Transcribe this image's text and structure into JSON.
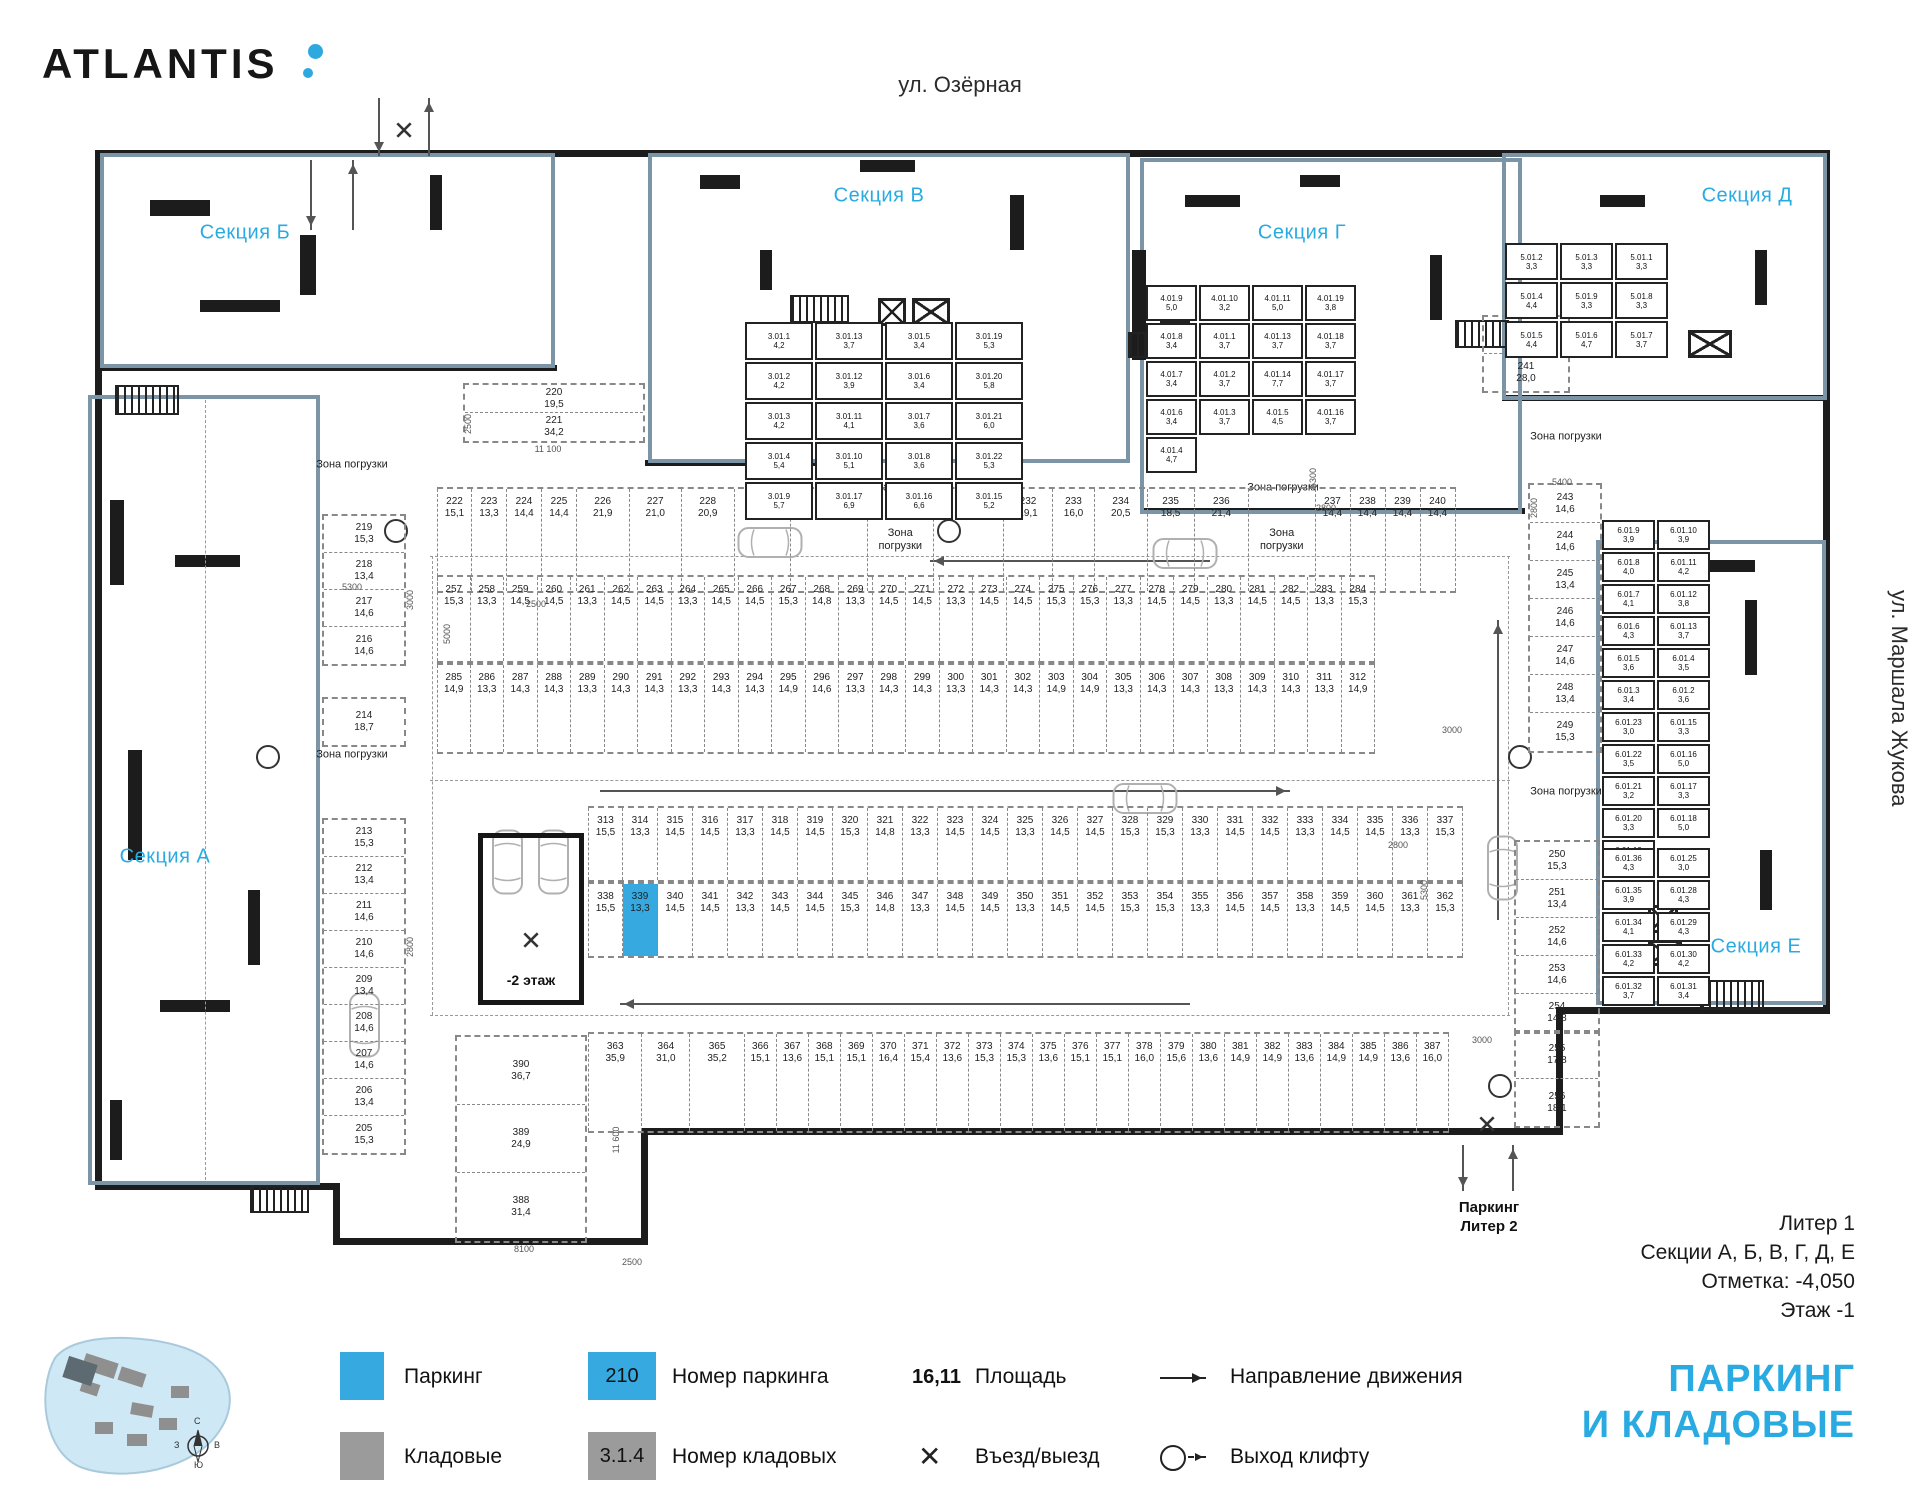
{
  "header": {
    "brand": "ATLANTIS",
    "street_top": "ул. Озёрная",
    "street_right": "ул. Маршала Жукова"
  },
  "sections": {
    "a": "Секция А",
    "b": "Секция Б",
    "v": "Секция В",
    "g": "Секция Г",
    "d": "Секция Д",
    "e": "Секция Е"
  },
  "labels": {
    "zone": "Зона погрузки",
    "ramp": "-2 этаж",
    "exit_l1": "Паркинг",
    "exit_l2": "Литер 2"
  },
  "highlight": {
    "parking_number": "339"
  },
  "plan": {
    "row_top": [
      {
        "n": "222",
        "a": "15,1"
      },
      {
        "n": "223",
        "a": "13,3"
      },
      {
        "n": "224",
        "a": "14,4"
      },
      {
        "n": "225",
        "a": "14,4"
      },
      {
        "n": "226",
        "a": "21,9",
        "w": 1.5
      },
      {
        "n": "227",
        "a": "21,0",
        "w": 1.5
      },
      {
        "n": "228",
        "a": "20,9",
        "w": 1.5
      },
      {
        "n": "229",
        "a": "22,4",
        "w": 1.6
      },
      {
        "n": "230",
        "a": "32,3",
        "w": 2.2
      },
      {
        "z": true,
        "w": 1.9
      },
      {
        "n": "231",
        "a": "28,2",
        "w": 2.0
      },
      {
        "n": "232",
        "a": "19,1",
        "w": 1.4
      },
      {
        "n": "233",
        "a": "16,0",
        "w": 1.2
      },
      {
        "n": "234",
        "a": "20,5",
        "w": 1.5
      },
      {
        "n": "235",
        "a": "18,5",
        "w": 1.35
      },
      {
        "n": "236",
        "a": "21,4",
        "w": 1.55
      },
      {
        "z": true,
        "w": 1.9
      },
      {
        "n": "237",
        "a": "14,4"
      },
      {
        "n": "238",
        "a": "14,4"
      },
      {
        "n": "239",
        "a": "14,4"
      },
      {
        "n": "240",
        "a": "14,4"
      }
    ],
    "row_a": [
      {
        "n": "257",
        "a": "15,3"
      },
      {
        "n": "258",
        "a": "13,3"
      },
      {
        "n": "259",
        "a": "14,5"
      },
      {
        "n": "260",
        "a": "14,5"
      },
      {
        "n": "261",
        "a": "13,3"
      },
      {
        "n": "262",
        "a": "14,5"
      },
      {
        "n": "263",
        "a": "14,5"
      },
      {
        "n": "264",
        "a": "13,3"
      },
      {
        "n": "265",
        "a": "14,5"
      },
      {
        "n": "266",
        "a": "14,5"
      },
      {
        "n": "267",
        "a": "15,3"
      },
      {
        "n": "268",
        "a": "14,8"
      },
      {
        "n": "269",
        "a": "13,3"
      },
      {
        "n": "270",
        "a": "14,5"
      },
      {
        "n": "271",
        "a": "14,5"
      },
      {
        "n": "272",
        "a": "13,3"
      },
      {
        "n": "273",
        "a": "14,5"
      },
      {
        "n": "274",
        "a": "14,5"
      },
      {
        "n": "275",
        "a": "15,3"
      },
      {
        "n": "276",
        "a": "15,3"
      },
      {
        "n": "277",
        "a": "13,3"
      },
      {
        "n": "278",
        "a": "14,5"
      },
      {
        "n": "279",
        "a": "14,5"
      },
      {
        "n": "280",
        "a": "13,3"
      },
      {
        "n": "281",
        "a": "14,5"
      },
      {
        "n": "282",
        "a": "14,5"
      },
      {
        "n": "283",
        "a": "13,3"
      },
      {
        "n": "284",
        "a": "15,3"
      }
    ],
    "row_b": [
      {
        "n": "285",
        "a": "14,9"
      },
      {
        "n": "286",
        "a": "13,3"
      },
      {
        "n": "287",
        "a": "14,3"
      },
      {
        "n": "288",
        "a": "14,3"
      },
      {
        "n": "289",
        "a": "13,3"
      },
      {
        "n": "290",
        "a": "14,3"
      },
      {
        "n": "291",
        "a": "14,3"
      },
      {
        "n": "292",
        "a": "13,3"
      },
      {
        "n": "293",
        "a": "14,3"
      },
      {
        "n": "294",
        "a": "14,3"
      },
      {
        "n": "295",
        "a": "14,9"
      },
      {
        "n": "296",
        "a": "14,6"
      },
      {
        "n": "297",
        "a": "13,3"
      },
      {
        "n": "298",
        "a": "14,3"
      },
      {
        "n": "299",
        "a": "14,3"
      },
      {
        "n": "300",
        "a": "13,3"
      },
      {
        "n": "301",
        "a": "14,3"
      },
      {
        "n": "302",
        "a": "14,3"
      },
      {
        "n": "303",
        "a": "14,9"
      },
      {
        "n": "304",
        "a": "14,9"
      },
      {
        "n": "305",
        "a": "13,3"
      },
      {
        "n": "306",
        "a": "14,3"
      },
      {
        "n": "307",
        "a": "14,3"
      },
      {
        "n": "308",
        "a": "13,3"
      },
      {
        "n": "309",
        "a": "14,3"
      },
      {
        "n": "310",
        "a": "14,3"
      },
      {
        "n": "311",
        "a": "13,3"
      },
      {
        "n": "312",
        "a": "14,9"
      }
    ],
    "row_c": [
      {
        "n": "313",
        "a": "15,5"
      },
      {
        "n": "314",
        "a": "13,3"
      },
      {
        "n": "315",
        "a": "14,5"
      },
      {
        "n": "316",
        "a": "14,5"
      },
      {
        "n": "317",
        "a": "13,3"
      },
      {
        "n": "318",
        "a": "14,5"
      },
      {
        "n": "319",
        "a": "14,5"
      },
      {
        "n": "320",
        "a": "15,3"
      },
      {
        "n": "321",
        "a": "14,8"
      },
      {
        "n": "322",
        "a": "13,3"
      },
      {
        "n": "323",
        "a": "14,5"
      },
      {
        "n": "324",
        "a": "14,5"
      },
      {
        "n": "325",
        "a": "13,3"
      },
      {
        "n": "326",
        "a": "14,5"
      },
      {
        "n": "327",
        "a": "14,5"
      },
      {
        "n": "328",
        "a": "15,3"
      },
      {
        "n": "329",
        "a": "15,3"
      },
      {
        "n": "330",
        "a": "13,3"
      },
      {
        "n": "331",
        "a": "14,5"
      },
      {
        "n": "332",
        "a": "14,5"
      },
      {
        "n": "333",
        "a": "13,3"
      },
      {
        "n": "334",
        "a": "14,5"
      },
      {
        "n": "335",
        "a": "14,5"
      },
      {
        "n": "336",
        "a": "13,3"
      },
      {
        "n": "337",
        "a": "15,3"
      }
    ],
    "row_d": [
      {
        "n": "338",
        "a": "15,5"
      },
      {
        "n": "339",
        "a": "13,3"
      },
      {
        "n": "340",
        "a": "14,5"
      },
      {
        "n": "341",
        "a": "14,5"
      },
      {
        "n": "342",
        "a": "13,3"
      },
      {
        "n": "343",
        "a": "14,5"
      },
      {
        "n": "344",
        "a": "14,5"
      },
      {
        "n": "345",
        "a": "15,3"
      },
      {
        "n": "346",
        "a": "14,8"
      },
      {
        "n": "347",
        "a": "13,3"
      },
      {
        "n": "348",
        "a": "14,5"
      },
      {
        "n": "349",
        "a": "14,5"
      },
      {
        "n": "350",
        "a": "13,3"
      },
      {
        "n": "351",
        "a": "14,5"
      },
      {
        "n": "352",
        "a": "14,5"
      },
      {
        "n": "353",
        "a": "15,3"
      },
      {
        "n": "354",
        "a": "15,3"
      },
      {
        "n": "355",
        "a": "13,3"
      },
      {
        "n": "356",
        "a": "14,5"
      },
      {
        "n": "357",
        "a": "14,5"
      },
      {
        "n": "358",
        "a": "13,3"
      },
      {
        "n": "359",
        "a": "14,5"
      },
      {
        "n": "360",
        "a": "14,5"
      },
      {
        "n": "361",
        "a": "13,3"
      },
      {
        "n": "362",
        "a": "15,3"
      }
    ],
    "row_e": [
      {
        "n": "363",
        "a": "35,9",
        "w": 1.7
      },
      {
        "n": "364",
        "a": "31,0",
        "w": 1.5
      },
      {
        "n": "365",
        "a": "35,2",
        "w": 1.7
      },
      {
        "n": "366",
        "a": "15,1"
      },
      {
        "n": "367",
        "a": "13,6"
      },
      {
        "n": "368",
        "a": "15,1"
      },
      {
        "n": "369",
        "a": "15,1"
      },
      {
        "n": "370",
        "a": "16,4"
      },
      {
        "n": "371",
        "a": "15,4"
      },
      {
        "n": "372",
        "a": "13,6"
      },
      {
        "n": "373",
        "a": "15,3"
      },
      {
        "n": "374",
        "a": "15,3"
      },
      {
        "n": "375",
        "a": "13,6"
      },
      {
        "n": "376",
        "a": "15,1"
      },
      {
        "n": "377",
        "a": "15,1"
      },
      {
        "n": "378",
        "a": "16,0"
      },
      {
        "n": "379",
        "a": "15,6"
      },
      {
        "n": "380",
        "a": "13,6"
      },
      {
        "n": "381",
        "a": "14,9"
      },
      {
        "n": "382",
        "a": "14,9"
      },
      {
        "n": "383",
        "a": "13,6"
      },
      {
        "n": "384",
        "a": "14,9"
      },
      {
        "n": "385",
        "a": "14,9"
      },
      {
        "n": "386",
        "a": "13,6"
      },
      {
        "n": "387",
        "a": "16,0"
      }
    ],
    "pair_220": [
      {
        "n": "220",
        "a": "19,5"
      },
      {
        "n": "221",
        "a": "34,2"
      }
    ],
    "left_col_top": [
      {
        "n": "219",
        "a": "15,3"
      },
      {
        "n": "218",
        "a": "13,4"
      },
      {
        "n": "217",
        "a": "14,6"
      },
      {
        "n": "216",
        "a": "14,6"
      }
    ],
    "cell_214": [
      {
        "n": "214",
        "a": "18,7"
      }
    ],
    "left_col_bottom": [
      {
        "n": "213",
        "a": "15,3"
      },
      {
        "n": "212",
        "a": "13,4"
      },
      {
        "n": "211",
        "a": "14,6"
      },
      {
        "n": "210",
        "a": "14,6"
      },
      {
        "n": "209",
        "a": "13,4"
      },
      {
        "n": "208",
        "a": "14,6"
      },
      {
        "n": "207",
        "a": "14,6"
      },
      {
        "n": "206",
        "a": "13,4"
      },
      {
        "n": "205",
        "a": "15,3"
      }
    ],
    "pair_242": [
      {
        "n": "242",
        "a": "20,3"
      },
      {
        "n": "241",
        "a": "28,0"
      }
    ],
    "right_col_top": [
      {
        "n": "243",
        "a": "14,6"
      },
      {
        "n": "244",
        "a": "14,6"
      },
      {
        "n": "245",
        "a": "13,4"
      },
      {
        "n": "246",
        "a": "14,6"
      },
      {
        "n": "247",
        "a": "14,6"
      },
      {
        "n": "248",
        "a": "13,4"
      },
      {
        "n": "249",
        "a": "15,3"
      }
    ],
    "right_col_bottom": [
      {
        "n": "250",
        "a": "15,3"
      },
      {
        "n": "251",
        "a": "13,4"
      },
      {
        "n": "252",
        "a": "14,6"
      },
      {
        "n": "253",
        "a": "14,6"
      },
      {
        "n": "254",
        "a": "14,8"
      }
    ],
    "cells_255_256": [
      {
        "n": "255",
        "a": "17,8"
      },
      {
        "n": "256",
        "a": "18,1"
      }
    ],
    "block_388_390": [
      {
        "n": "390",
        "a": "36,7"
      },
      {
        "n": "389",
        "a": "24,9"
      },
      {
        "n": "388",
        "a": "31,4"
      }
    ],
    "storage_v": [
      {
        "n": "3.01.1",
        "a": "4,2"
      },
      {
        "n": "3.01.13",
        "a": "3,7"
      },
      {
        "n": "3.01.5",
        "a": "3,4"
      },
      {
        "n": "3.01.19",
        "a": "5,3"
      },
      {
        "n": "3.01.2",
        "a": "4,2"
      },
      {
        "n": "3.01.12",
        "a": "3,9"
      },
      {
        "n": "3.01.6",
        "a": "3,4"
      },
      {
        "n": "3.01.20",
        "a": "5,8"
      },
      {
        "n": "3.01.3",
        "a": "4,2"
      },
      {
        "n": "3.01.11",
        "a": "4,1"
      },
      {
        "n": "3.01.7",
        "a": "3,6"
      },
      {
        "n": "3.01.21",
        "a": "6,0"
      },
      {
        "n": "3.01.4",
        "a": "5,4"
      },
      {
        "n": "3.01.10",
        "a": "5,1"
      },
      {
        "n": "3.01.8",
        "a": "3,6"
      },
      {
        "n": "3.01.22",
        "a": "5,3"
      },
      {
        "n": "3.01.9",
        "a": "5,7"
      },
      {
        "n": "3.01.17",
        "a": "6,9"
      },
      {
        "n": "3.01.16",
        "a": "6,6"
      },
      {
        "n": "3.01.15",
        "a": "5,2"
      }
    ],
    "storage_g": [
      {
        "n": "4.01.9",
        "a": "5,0"
      },
      {
        "n": "4.01.10",
        "a": "3,2"
      },
      {
        "n": "4.01.11",
        "a": "5,0"
      },
      {
        "n": "4.01.19",
        "a": "3,8"
      },
      {
        "n": "4.01.8",
        "a": "3,4"
      },
      {
        "n": "4.01.1",
        "a": "3,7"
      },
      {
        "n": "4.01.13",
        "a": "3,7"
      },
      {
        "n": "4.01.18",
        "a": "3,7"
      },
      {
        "n": "4.01.7",
        "a": "3,4"
      },
      {
        "n": "4.01.2",
        "a": "3,7"
      },
      {
        "n": "4.01.14",
        "a": "7,7"
      },
      {
        "n": "4.01.17",
        "a": "3,7"
      },
      {
        "n": "4.01.6",
        "a": "3,4"
      },
      {
        "n": "4.01.3",
        "a": "3,7"
      },
      {
        "n": "4.01.5",
        "a": "4,5"
      },
      {
        "n": "4.01.16",
        "a": "3,7"
      },
      {
        "n": "4.01.4",
        "a": "4,7"
      }
    ],
    "storage_d": [
      {
        "n": "5.01.2",
        "a": "3,3"
      },
      {
        "n": "5.01.3",
        "a": "3,3"
      },
      {
        "n": "5.01.1",
        "a": "3,3"
      },
      {
        "n": "5.01.4",
        "a": "4,4"
      },
      {
        "n": "5.01.9",
        "a": "3,3"
      },
      {
        "n": "5.01.8",
        "a": "3,3"
      },
      {
        "n": "5.01.5",
        "a": "4,4"
      },
      {
        "n": "5.01.6",
        "a": "4,7"
      },
      {
        "n": "5.01.7",
        "a": "3,7"
      }
    ],
    "storage_e_upper": [
      {
        "n": "6.01.9",
        "a": "3,9"
      },
      {
        "n": "6.01.10",
        "a": "3,9"
      },
      {
        "n": "6.01.8",
        "a": "4,0"
      },
      {
        "n": "6.01.11",
        "a": "4,2"
      },
      {
        "n": "6.01.7",
        "a": "4,1"
      },
      {
        "n": "6.01.12",
        "a": "3,8"
      },
      {
        "n": "6.01.6",
        "a": "4,3"
      },
      {
        "n": "6.01.13",
        "a": "3,7"
      },
      {
        "n": "6.01.5",
        "a": "3,6"
      },
      {
        "n": "6.01.4",
        "a": "3,5"
      },
      {
        "n": "6.01.3",
        "a": "3,4"
      },
      {
        "n": "6.01.2",
        "a": "3,6"
      },
      {
        "n": "6.01.23",
        "a": "3,0"
      },
      {
        "n": "6.01.15",
        "a": "3,3"
      },
      {
        "n": "6.01.22",
        "a": "3,5"
      },
      {
        "n": "6.01.16",
        "a": "5,0"
      },
      {
        "n": "6.01.21",
        "a": "3,2"
      },
      {
        "n": "6.01.17",
        "a": "3,3"
      },
      {
        "n": "6.01.20",
        "a": "3,3"
      },
      {
        "n": "6.01.18",
        "a": "5,0"
      },
      {
        "n": "6.01.19",
        "a": "3,2"
      }
    ],
    "storage_e_lower": [
      {
        "n": "6.01.36",
        "a": "4,3"
      },
      {
        "n": "6.01.25",
        "a": "3,0"
      },
      {
        "n": "6.01.35",
        "a": "3,9"
      },
      {
        "n": "6.01.28",
        "a": "4,3"
      },
      {
        "n": "6.01.34",
        "a": "4,1"
      },
      {
        "n": "6.01.29",
        "a": "4,3"
      },
      {
        "n": "6.01.33",
        "a": "4,2"
      },
      {
        "n": "6.01.30",
        "a": "4,2"
      },
      {
        "n": "6.01.32",
        "a": "3,7"
      },
      {
        "n": "6.01.31",
        "a": "3,4"
      }
    ],
    "dims": [
      {
        "t": "11 100",
        "x": 548,
        "y": 449
      },
      {
        "t": "2500",
        "x": 468,
        "y": 424,
        "r": 1
      },
      {
        "t": "2500",
        "x": 536,
        "y": 604
      },
      {
        "t": "5000",
        "x": 447,
        "y": 634,
        "r": 1
      },
      {
        "t": "5300",
        "x": 352,
        "y": 587
      },
      {
        "t": "3000",
        "x": 410,
        "y": 600,
        "r": 1
      },
      {
        "t": "2800",
        "x": 410,
        "y": 947,
        "r": 1
      },
      {
        "t": "5300",
        "x": 1313,
        "y": 478,
        "r": 1
      },
      {
        "t": "2800",
        "x": 1326,
        "y": 508
      },
      {
        "t": "3000",
        "x": 1452,
        "y": 730
      },
      {
        "t": "2800",
        "x": 1398,
        "y": 845
      },
      {
        "t": "5300",
        "x": 1424,
        "y": 890,
        "r": 1
      },
      {
        "t": "3000",
        "x": 1482,
        "y": 1040
      },
      {
        "t": "5400",
        "x": 1562,
        "y": 482
      },
      {
        "t": "2800",
        "x": 1534,
        "y": 508,
        "r": 1
      },
      {
        "t": "8100",
        "x": 524,
        "y": 1249
      },
      {
        "t": "11 600",
        "x": 616,
        "y": 1140,
        "r": 1
      },
      {
        "t": "2500",
        "x": 632,
        "y": 1262
      }
    ]
  },
  "legend": {
    "parking": "Паркинг",
    "storage": "Кладовые",
    "parking_num_box": "210",
    "parking_num": "Номер паркинга",
    "storage_num_box": "3.1.4",
    "storage_num": "Номер кладовых",
    "area_sample": "16,11",
    "area": "Площадь",
    "direction": "Направление движения",
    "entry": "Въезд/выезд",
    "lift": "Выход клифту"
  },
  "info": {
    "l1": "Литер 1",
    "l2": "Секции А, Б, В, Г, Д, Е",
    "l3": "Отметка:  -4,050",
    "l4": "Этаж  -1"
  },
  "title": {
    "l1": "ПАРКИНГ",
    "l2": "И КЛАДОВЫЕ"
  },
  "compass": {
    "n": "С",
    "e": "В",
    "s": "Ю",
    "w": "З"
  },
  "colors": {
    "accent": "#29abe2",
    "parking_fill": "#36a9e0",
    "storage_fill": "#9b9b9b",
    "section_outline": "#7b95a6",
    "walls": "#1c1c1c",
    "map_water": "#cfe8f5"
  }
}
